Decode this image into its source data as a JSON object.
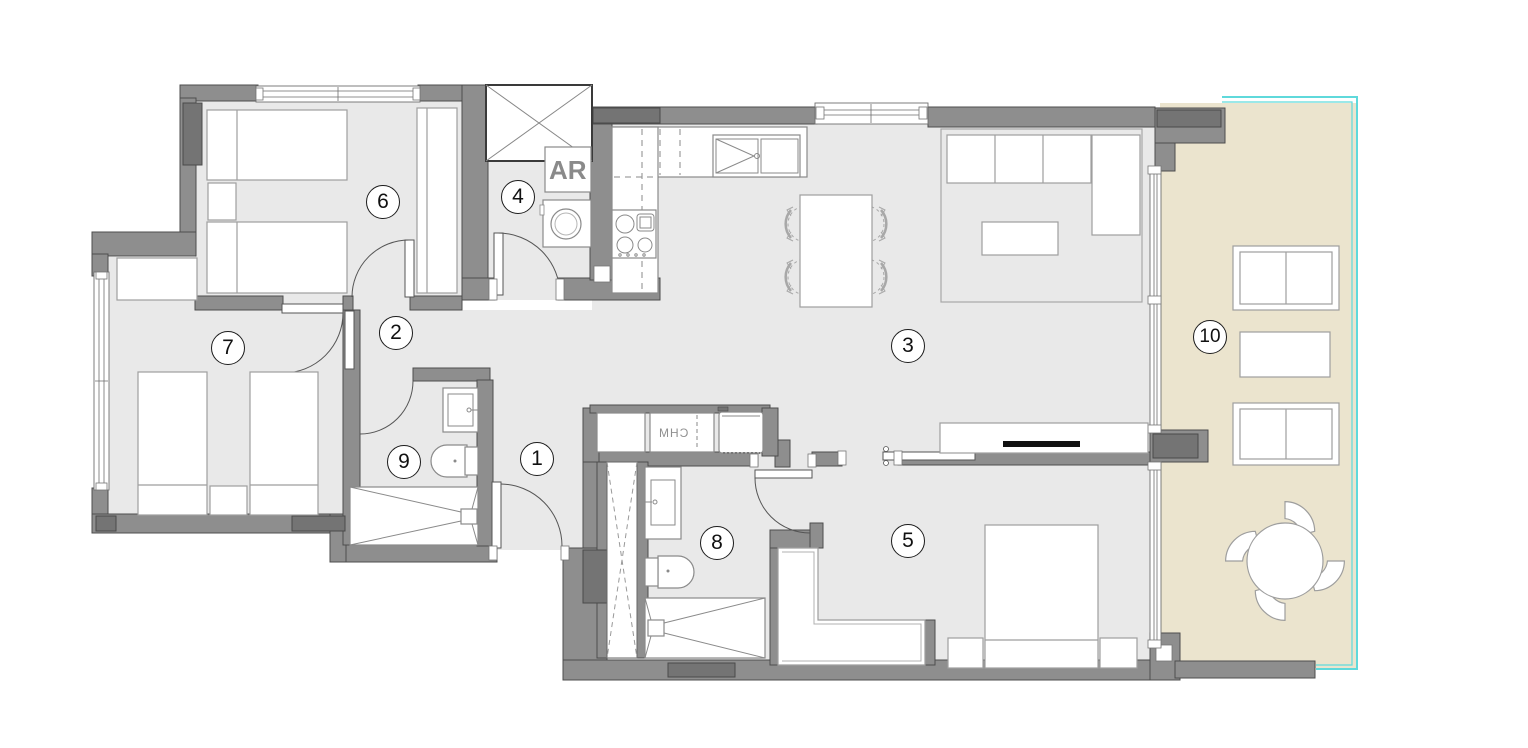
{
  "floor_plan": {
    "room_markers": [
      "1",
      "2",
      "3",
      "4",
      "5",
      "6",
      "7",
      "8",
      "9",
      "10"
    ],
    "text_annotations": {
      "laundry_unit": "AR",
      "heater_closet": "CHM"
    },
    "colors": {
      "wall": "#8E8E8E",
      "wall_dark": "#747474",
      "floor": "#E9E9E9",
      "terrace_floor": "#EBE4CE",
      "glass_railing": "#5FD9DB",
      "wardrobe_rail": "#111111"
    }
  }
}
